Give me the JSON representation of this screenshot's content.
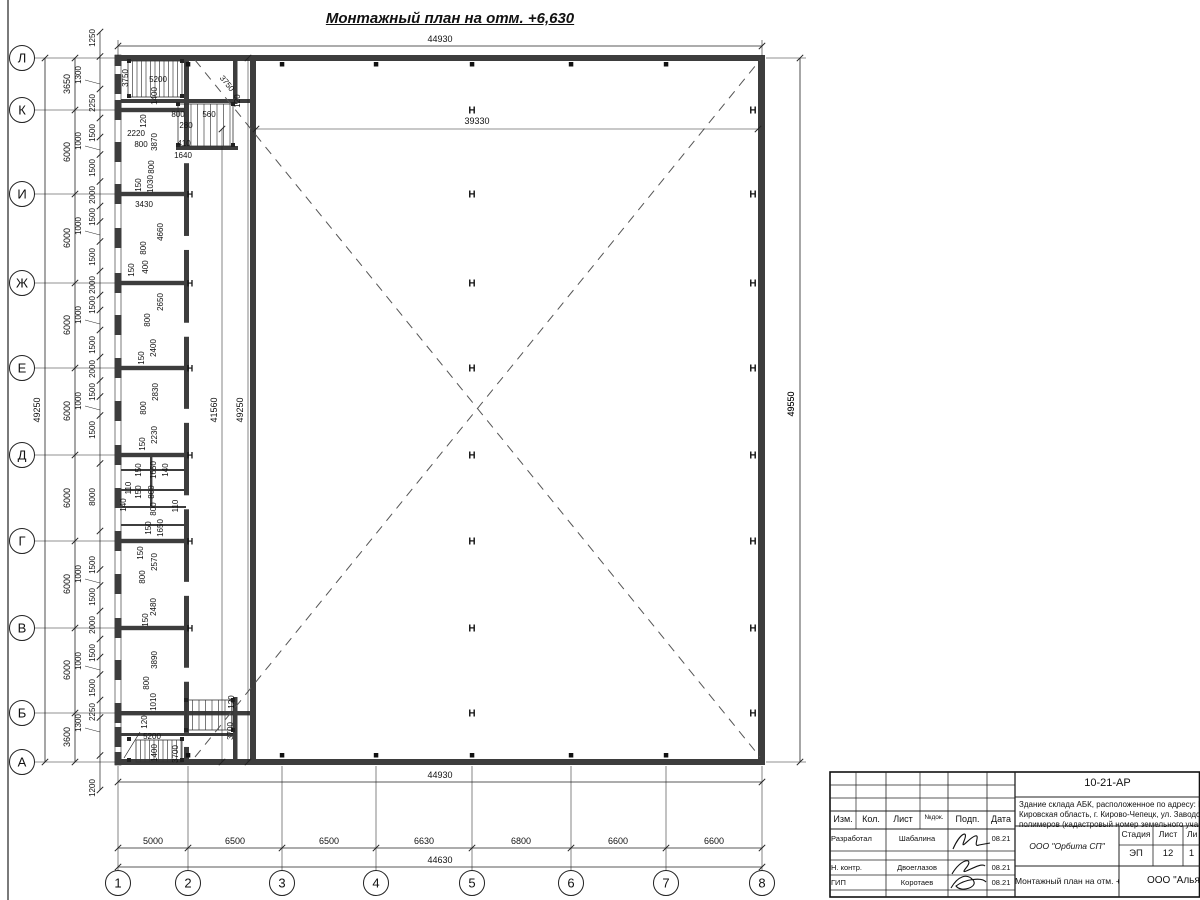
{
  "drawing_title": "Монтажный план на отм. +6,630",
  "overall_width_top": "44930",
  "overall_width_bottom": "44930",
  "col_total": "44630",
  "row_total": "49250",
  "right_total": "49550",
  "hall_width": "39330",
  "hall_height": "41560",
  "inner_height": "49250",
  "column_marker": "Н",
  "axis_rows": [
    {
      "label": "Л",
      "y": 58
    },
    {
      "label": "К",
      "y": 110
    },
    {
      "label": "И",
      "y": 194
    },
    {
      "label": "Ж",
      "y": 283
    },
    {
      "label": "Е",
      "y": 368
    },
    {
      "label": "Д",
      "y": 455
    },
    {
      "label": "Г",
      "y": 541
    },
    {
      "label": "В",
      "y": 628
    },
    {
      "label": "Б",
      "y": 713
    },
    {
      "label": "А",
      "y": 762
    }
  ],
  "axis_cols": [
    {
      "label": "1",
      "x": 118
    },
    {
      "label": "2",
      "x": 188
    },
    {
      "label": "3",
      "x": 282
    },
    {
      "label": "4",
      "x": 376
    },
    {
      "label": "5",
      "x": 472
    },
    {
      "label": "6",
      "x": 571
    },
    {
      "label": "7",
      "x": 666
    },
    {
      "label": "8",
      "x": 762
    }
  ],
  "row_spacings": [
    {
      "text": "3650",
      "y": 84
    },
    {
      "text": "6000",
      "y": 152
    },
    {
      "text": "6000",
      "y": 238
    },
    {
      "text": "6000",
      "y": 325
    },
    {
      "text": "6000",
      "y": 411
    },
    {
      "text": "6000",
      "y": 498
    },
    {
      "text": "6000",
      "y": 584
    },
    {
      "text": "6000",
      "y": 670
    },
    {
      "text": "3600",
      "y": 737
    }
  ],
  "col_spacings": [
    {
      "text": "5000",
      "x": 153
    },
    {
      "text": "6500",
      "x": 235
    },
    {
      "text": "6500",
      "x": 329
    },
    {
      "text": "6630",
      "x": 424
    },
    {
      "text": "6800",
      "x": 521
    },
    {
      "text": "6600",
      "x": 618
    },
    {
      "text": "6600",
      "x": 714
    }
  ],
  "left_chain": [
    {
      "text": "1250",
      "y": 38
    },
    {
      "text": "1300",
      "y": 75,
      "leader": true
    },
    {
      "text": "2250",
      "y": 103
    },
    {
      "text": "1500",
      "y": 133
    },
    {
      "text": "1000",
      "y": 141,
      "leader": true
    },
    {
      "text": "1500",
      "y": 168
    },
    {
      "text": "2000",
      "y": 195
    },
    {
      "text": "1500",
      "y": 217
    },
    {
      "text": "1000",
      "y": 226,
      "leader": true
    },
    {
      "text": "1500",
      "y": 257
    },
    {
      "text": "2000",
      "y": 285
    },
    {
      "text": "1500",
      "y": 305
    },
    {
      "text": "1000",
      "y": 315,
      "leader": true
    },
    {
      "text": "1500",
      "y": 345
    },
    {
      "text": "2000",
      "y": 369
    },
    {
      "text": "1500",
      "y": 392
    },
    {
      "text": "1000",
      "y": 401,
      "leader": true
    },
    {
      "text": "1500",
      "y": 430
    },
    {
      "text": "8000",
      "y": 497
    },
    {
      "text": "1500",
      "y": 565
    },
    {
      "text": "1000",
      "y": 574,
      "leader": true
    },
    {
      "text": "1500",
      "y": 597
    },
    {
      "text": "2000",
      "y": 625
    },
    {
      "text": "1500",
      "y": 653
    },
    {
      "text": "1000",
      "y": 661,
      "leader": true
    },
    {
      "text": "1500",
      "y": 688
    },
    {
      "text": "2250",
      "y": 712
    },
    {
      "text": "1300",
      "y": 723,
      "leader": true
    },
    {
      "text": "1200",
      "y": 788
    }
  ],
  "plan_labels": [
    {
      "t": "3750",
      "x": 128,
      "y": 78,
      "r": -90
    },
    {
      "t": "5200",
      "x": 158,
      "y": 82,
      "r": 0
    },
    {
      "t": "1400",
      "x": 157,
      "y": 96,
      "r": -90
    },
    {
      "t": "120",
      "x": 146,
      "y": 121,
      "r": -90
    },
    {
      "t": "800",
      "x": 178,
      "y": 117,
      "r": 0
    },
    {
      "t": "280",
      "x": 186,
      "y": 128,
      "r": 0
    },
    {
      "t": "560",
      "x": 209,
      "y": 117,
      "r": 0
    },
    {
      "t": "2220",
      "x": 136,
      "y": 136,
      "r": 0
    },
    {
      "t": "800",
      "x": 141,
      "y": 147,
      "r": 0
    },
    {
      "t": "3870",
      "x": 157,
      "y": 142,
      "r": -90
    },
    {
      "t": "410",
      "x": 184,
      "y": 146,
      "r": 0
    },
    {
      "t": "1640",
      "x": 183,
      "y": 158,
      "r": 0
    },
    {
      "t": "800",
      "x": 154,
      "y": 167,
      "r": -90
    },
    {
      "t": "150",
      "x": 141,
      "y": 185,
      "r": -90
    },
    {
      "t": "1030",
      "x": 153,
      "y": 184,
      "r": -90
    },
    {
      "t": "3430",
      "x": 144,
      "y": 207,
      "r": 0
    },
    {
      "t": "4660",
      "x": 163,
      "y": 232,
      "r": -90
    },
    {
      "t": "800",
      "x": 146,
      "y": 248,
      "r": -90
    },
    {
      "t": "400",
      "x": 148,
      "y": 267,
      "r": -90
    },
    {
      "t": "150",
      "x": 134,
      "y": 270,
      "r": -90
    },
    {
      "t": "2650",
      "x": 163,
      "y": 302,
      "r": -90
    },
    {
      "t": "800",
      "x": 150,
      "y": 320,
      "r": -90
    },
    {
      "t": "2400",
      "x": 156,
      "y": 348,
      "r": -90
    },
    {
      "t": "150",
      "x": 144,
      "y": 358,
      "r": -90
    },
    {
      "t": "2830",
      "x": 158,
      "y": 392,
      "r": -90
    },
    {
      "t": "800",
      "x": 146,
      "y": 408,
      "r": -90
    },
    {
      "t": "2230",
      "x": 157,
      "y": 435,
      "r": -90
    },
    {
      "t": "150",
      "x": 145,
      "y": 444,
      "r": -90
    },
    {
      "t": "150",
      "x": 141,
      "y": 470,
      "r": -90
    },
    {
      "t": "1650",
      "x": 156,
      "y": 470,
      "r": -90
    },
    {
      "t": "140",
      "x": 168,
      "y": 470,
      "r": -90
    },
    {
      "t": "110",
      "x": 131,
      "y": 488,
      "r": -90
    },
    {
      "t": "150",
      "x": 141,
      "y": 492,
      "r": -90
    },
    {
      "t": "800",
      "x": 154,
      "y": 492,
      "r": -90
    },
    {
      "t": "140",
      "x": 126,
      "y": 505,
      "r": -90
    },
    {
      "t": "800",
      "x": 156,
      "y": 509,
      "r": -90
    },
    {
      "t": "110",
      "x": 178,
      "y": 506,
      "r": -90
    },
    {
      "t": "150",
      "x": 151,
      "y": 528,
      "r": -90
    },
    {
      "t": "1650",
      "x": 163,
      "y": 528,
      "r": -90
    },
    {
      "t": "150",
      "x": 143,
      "y": 553,
      "r": -90
    },
    {
      "t": "2570",
      "x": 157,
      "y": 562,
      "r": -90
    },
    {
      "t": "800",
      "x": 145,
      "y": 577,
      "r": -90
    },
    {
      "t": "2480",
      "x": 156,
      "y": 607,
      "r": -90
    },
    {
      "t": "150",
      "x": 148,
      "y": 620,
      "r": -90
    },
    {
      "t": "3890",
      "x": 157,
      "y": 660,
      "r": -90
    },
    {
      "t": "800",
      "x": 149,
      "y": 683,
      "r": -90
    },
    {
      "t": "1010",
      "x": 156,
      "y": 702,
      "r": -90
    },
    {
      "t": "120",
      "x": 147,
      "y": 722,
      "r": -90
    },
    {
      "t": "5200",
      "x": 152,
      "y": 739,
      "r": 0
    },
    {
      "t": "1400",
      "x": 157,
      "y": 753,
      "r": -90
    },
    {
      "t": "3700",
      "x": 178,
      "y": 754,
      "r": -90
    },
    {
      "t": "3700",
      "x": 233,
      "y": 731,
      "r": -90
    },
    {
      "t": "120",
      "x": 234,
      "y": 702,
      "r": -90
    },
    {
      "t": "3750",
      "x": 225,
      "y": 85,
      "r": 51
    },
    {
      "t": "120",
      "x": 240,
      "y": 101,
      "r": -90
    },
    {
      "t": "39330",
      "x": 477,
      "y": 124,
      "r": 0
    },
    {
      "t": "41560",
      "x": 217,
      "y": 410,
      "r": -90
    },
    {
      "t": "49250",
      "x": 243,
      "y": 410,
      "r": -90
    },
    {
      "t": "49550",
      "x": 794,
      "y": 404,
      "r": -90
    }
  ],
  "h_marks": {
    "mid_x": 472,
    "mid_rows": [
      110,
      194,
      283,
      368,
      455,
      541,
      628,
      713
    ],
    "right_x": 753,
    "right_rows": [
      110,
      194,
      283,
      368,
      455,
      541,
      628,
      713
    ],
    "corridor_x": 190,
    "corridor_rows": [
      194,
      283,
      368,
      455,
      541,
      628
    ]
  },
  "titleblock": {
    "doc_number": "10-21-АР",
    "address_lines": [
      "Здание склада АБК, расположенное по адресу: Российская Феде",
      "Кировская область, г. Кирово-Чепецк, ул. Заводская, площадка з",
      "полимеров (кадастровый номер земельного участка 43:42:0000"
    ],
    "org": "ООО \"Орбита СП\"",
    "sheet_title": "Монтажный план на отм. +6,630",
    "company": "ООО \"Альянс",
    "stage_label": "Стадия",
    "sheet_label": "Лист",
    "sheets_label": "Ли",
    "stage": "ЭП",
    "sheet": "12",
    "sheets": "1",
    "header_cols": [
      "Изм.",
      "Кол.",
      "Лист",
      "№док.",
      "Подп.",
      "Дата"
    ],
    "rows": [
      {
        "role": "Разработал",
        "name": "Шабалина",
        "date": "08.21"
      },
      {
        "role": "Н. контр.",
        "name": "Двоеглазов",
        "date": "08.21"
      },
      {
        "role": "ГИП",
        "name": "Коротаев",
        "date": "08.21"
      }
    ]
  }
}
